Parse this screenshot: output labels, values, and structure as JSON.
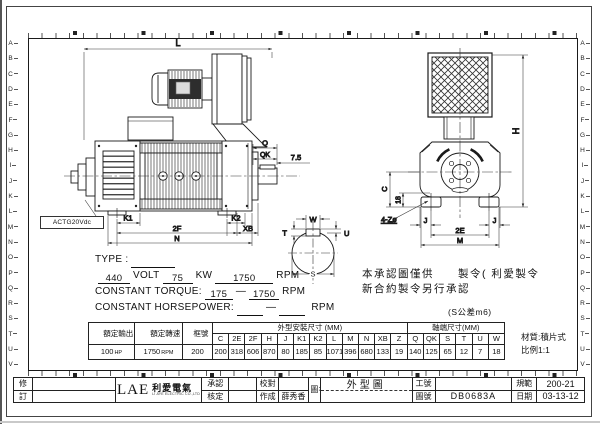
{
  "sheet": {
    "row_letters": [
      "A",
      "B",
      "C",
      "D",
      "E",
      "F",
      "G",
      "H",
      "I",
      "J",
      "K",
      "L",
      "M",
      "N",
      "O",
      "P",
      "Q",
      "R",
      "S",
      "T",
      "U",
      "V"
    ]
  },
  "drawing": {
    "tacho_label": "ACTG20Vdc",
    "note_line1": "本承認圖僅供　　製令( 利愛製令",
    "note_line2": "新合約製令另行承認",
    "tolerance_note": "(S公差m6)",
    "dims": {
      "L": "L",
      "Q": "Q",
      "QK": "QK",
      "d75": "7.5",
      "K1": "K1",
      "K2": "K2",
      "twoF": "2F",
      "XB": "XB",
      "N": "N",
      "W": "W",
      "T": "T",
      "U": "U",
      "S": "S",
      "H": "H",
      "C": "C",
      "d18": "18",
      "holes": "4-Zø",
      "J": "J",
      "twoE": "2E",
      "M": "M"
    }
  },
  "spec": {
    "type_label": "TYPE :",
    "volt_value": "440",
    "volt_label": "VOLT",
    "kw_value": "75",
    "kw_label": "KW",
    "rpm_value": "1750",
    "rpm_label": "RPM",
    "torque_label": "CONSTANT TORQUE:",
    "torque_from": "175",
    "torque_to": "1750",
    "hp_label": "CONSTANT HORSEPOWER:",
    "hp_from": "",
    "hp_to": "",
    "dash": "—"
  },
  "table": {
    "col_output": "額定輸出",
    "col_speed": "額定轉速",
    "col_frame": "框號",
    "outline_header": "外型安裝尺寸 (MM)",
    "shaft_header": "軸端尺寸(MM)",
    "output_value": "100",
    "output_unit": "HP",
    "speed_value": "1750",
    "speed_unit": "RPM",
    "frame_value": "200",
    "outline_cols": [
      "C",
      "2E",
      "2F",
      "H",
      "J",
      "K1",
      "K2",
      "L",
      "M",
      "N",
      "XB",
      "Z"
    ],
    "outline_values": [
      "200",
      "318",
      "606",
      "870",
      "80",
      "185",
      "85",
      "1071",
      "396",
      "680",
      "133",
      "19"
    ],
    "shaft_cols": [
      "Q",
      "QK",
      "S",
      "T",
      "U",
      "W"
    ],
    "shaft_values": [
      "140",
      "125",
      "65",
      "12",
      "7",
      "18"
    ],
    "material_note": "材質:積片式",
    "scale_note": "比例1:1"
  },
  "titleblock": {
    "rev_top": "修",
    "rev_bottom": "訂",
    "logo_text": "LAE",
    "logo_cn": "利愛電氣",
    "logo_sub": "LI AYE ELECTRIC CO.,LTD",
    "approved_label": "承認",
    "checked_label": "核定",
    "proof_label": "校對",
    "made_label": "作成",
    "made_value": "薛秀香",
    "name_label": "圖名",
    "drawing_title": "外型圖",
    "work_label": "工號",
    "work_value": "",
    "dwgno_label": "圖號",
    "dwgno_value": "DB0683A",
    "spec_label": "規範",
    "spec_value": "200-21",
    "date_label": "日期",
    "date_value": "03-13-12"
  }
}
